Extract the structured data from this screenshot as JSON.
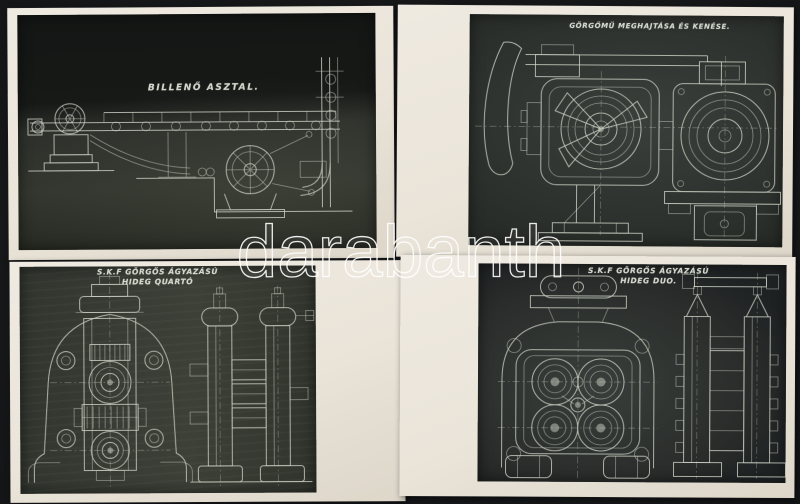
{
  "watermark": {
    "text": "darabanth"
  },
  "photos": [
    {
      "name": "billeno-asztal",
      "title": "BILLENŐ ASZTAL."
    },
    {
      "name": "gorgomu-meghajtasa",
      "title": "GÖRGŐMŰ MEGHAJTÁSA ÉS KENÉSE."
    },
    {
      "name": "hideg-quarto",
      "title_line1": "S.K.F GÖRGŐS ÁGYAZÁSÚ",
      "title_line2": "HIDEG QUARTÓ"
    },
    {
      "name": "hideg-duo",
      "title_line1": "S.K.F GÖRGŐS ÁGYAZÁSÚ",
      "title_line2": "HIDEG DUO."
    }
  ],
  "colors": {
    "background": "#131416",
    "photo_paper": "#eae4d9",
    "blueprint_dark": "#2e322c",
    "blueprint_line": "#cdd2c6",
    "watermark_stroke": "#ffffff"
  }
}
